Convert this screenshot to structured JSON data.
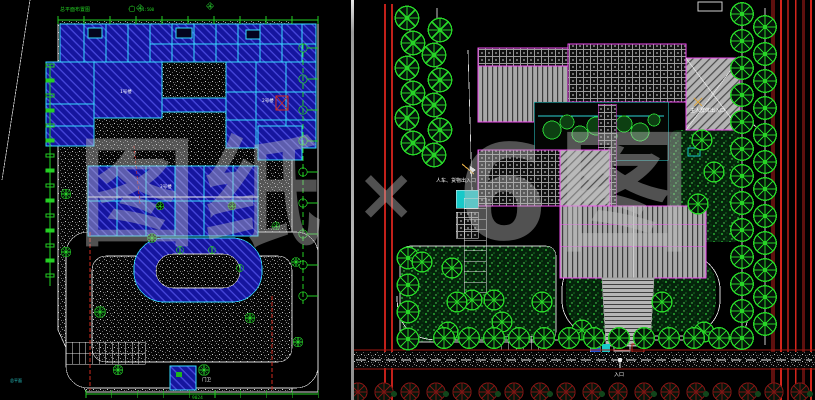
{
  "window": {
    "width": 815,
    "height": 400,
    "background": "#000000"
  },
  "watermark": {
    "left_text": "图纸",
    "separator": "×",
    "right_text": "6图"
  },
  "left_plan": {
    "caption_top": "总平面布置图",
    "scale_note": "1:500",
    "corner_note": "总平面",
    "labels": {
      "building_1": "1号楼",
      "building_2": "2号楼",
      "building_3": "3号楼",
      "gatehouse": "门卫"
    },
    "dimensions": {
      "bottom": "9024"
    }
  },
  "right_plan": {
    "labels": {
      "west_entry": "人车、货物出入口",
      "east_entry": "主人群体出入口",
      "south_entry": "入口"
    }
  },
  "colors": {
    "cad_blue": "#15159e",
    "cad_cyan": "#35dcff",
    "cad_green": "#23cf23",
    "cad_red": "#d02a1e",
    "cad_magenta": "#f24df2",
    "roof_gray": "#aaaaaa",
    "lawn_green": "#2fcf3c",
    "tree_green": "#27d427",
    "dark_red_tree": "#7d1413"
  }
}
